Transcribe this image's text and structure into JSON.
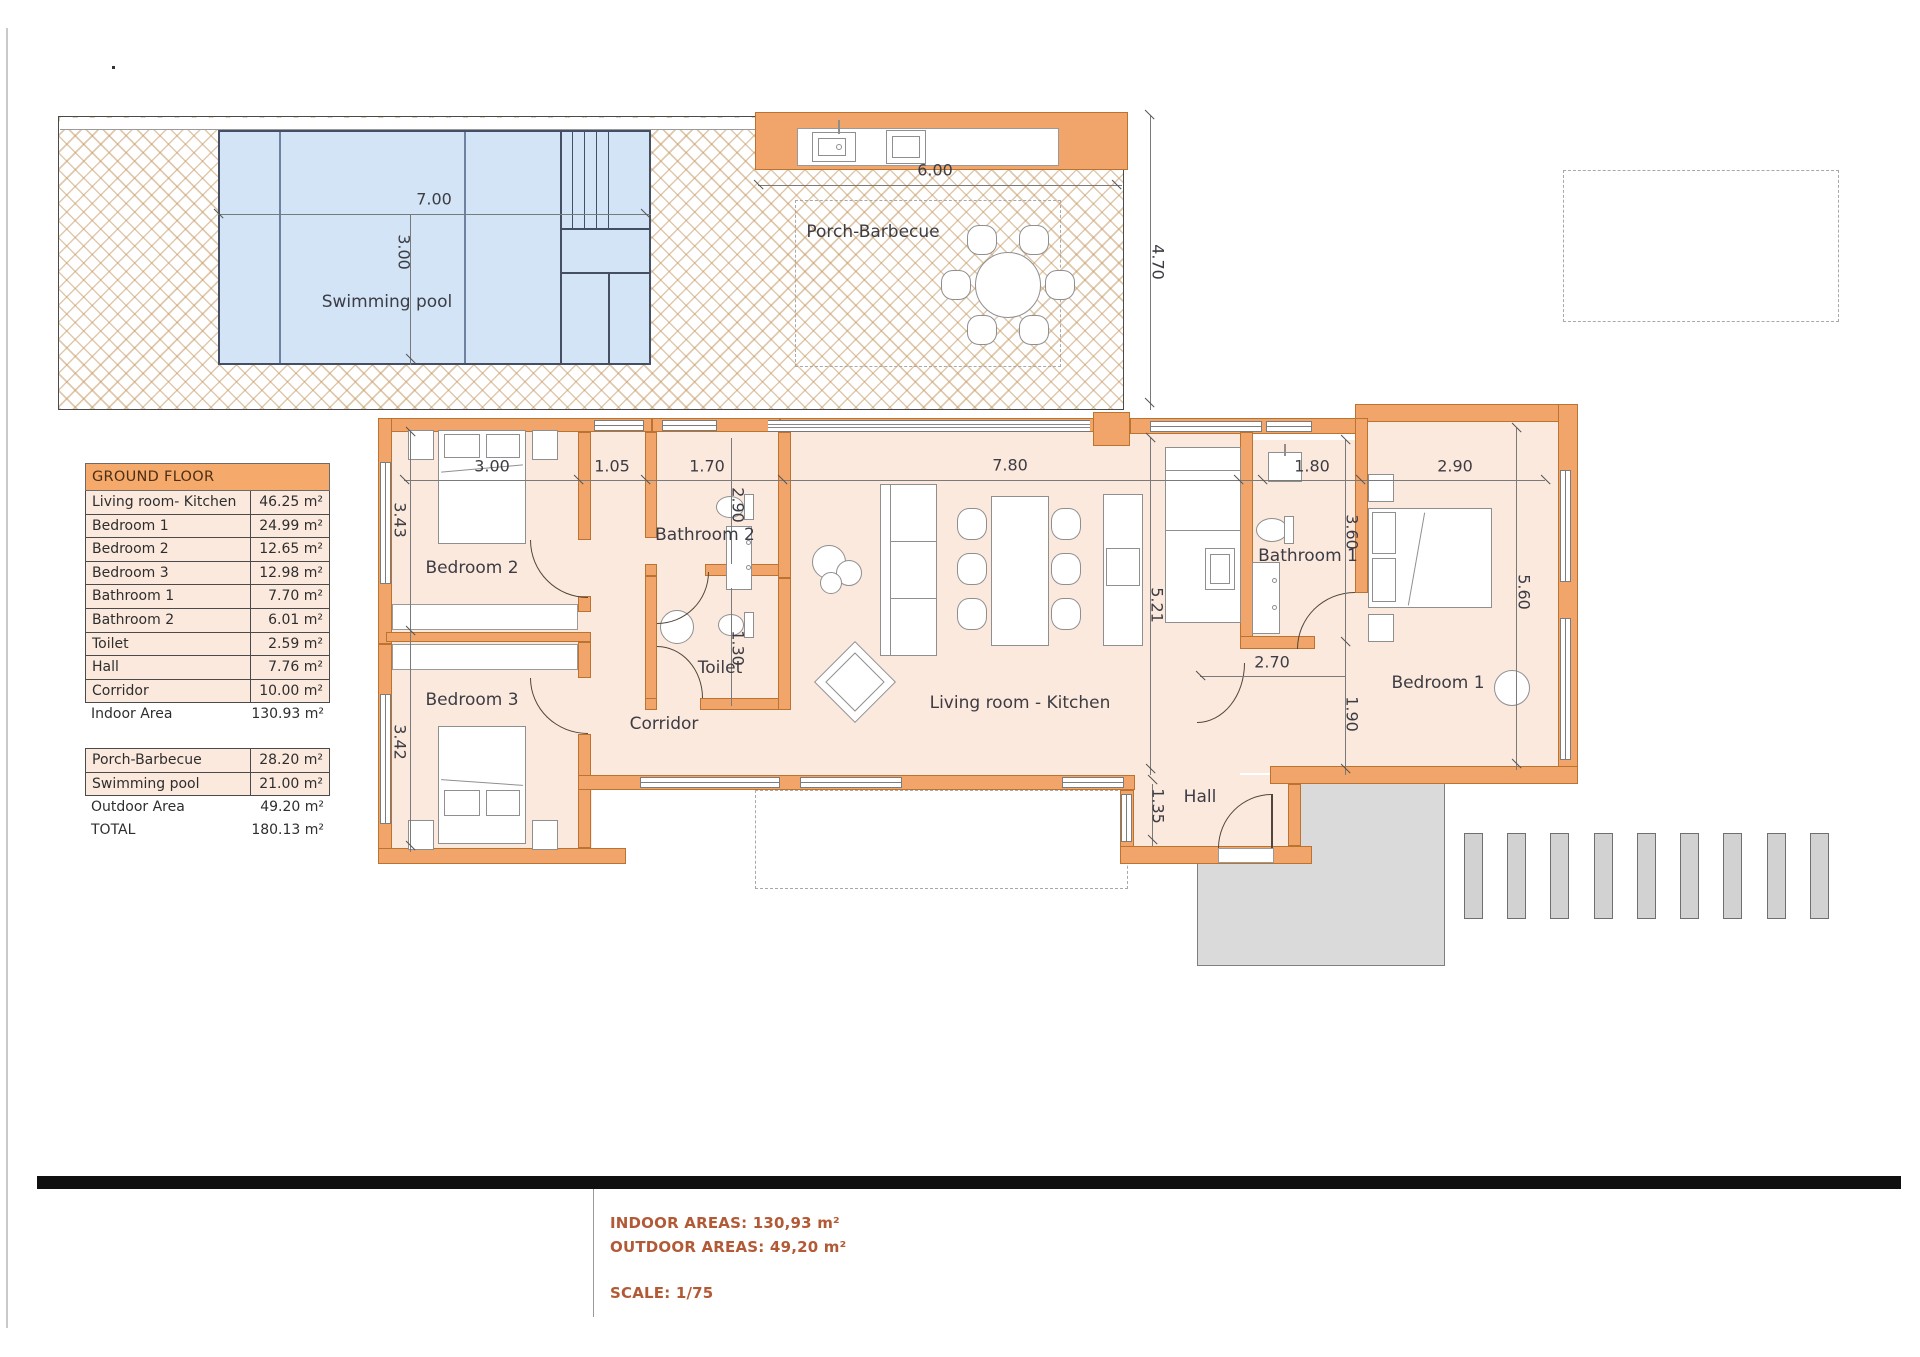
{
  "plan": {
    "room_labels": {
      "swimming_pool": "Swimming pool",
      "porch": "Porch-Barbecue",
      "bedroom1": "Bedroom 1",
      "bedroom2": "Bedroom 2",
      "bedroom3": "Bedroom 3",
      "bathroom1": "Bathroom 1",
      "bathroom2": "Bathroom 2",
      "toilet": "Toilet",
      "corridor": "Corridor",
      "living": "Living room - Kitchen",
      "hall": "Hall"
    },
    "dimensions": {
      "pool_w": "7.00",
      "pool_h": "3.00",
      "porch_w": "6.00",
      "porch_h": "4.70",
      "bed2_w": "3.00",
      "bed2_h": "3.43",
      "corr_top": "1.05",
      "bath2_w": "1.70",
      "bath2_h": "2.90",
      "toilet_h": "1.30",
      "bed3_h": "3.42",
      "living_w": "7.80",
      "living_h": "5.21",
      "bath1_w": "1.80",
      "bath1_h": "3.60",
      "bed1_w": "2.90",
      "bed1_h": "5.60",
      "entry_w": "2.70",
      "entry_h": "1.90",
      "hall_h": "1.35"
    }
  },
  "area_table": {
    "header": "GROUND FLOOR",
    "rows": [
      {
        "name": "Living room- Kitchen",
        "value": "46.25 m²"
      },
      {
        "name": "Bedroom 1",
        "value": "24.99 m²"
      },
      {
        "name": "Bedroom 2",
        "value": "12.65 m²"
      },
      {
        "name": "Bedroom 3",
        "value": "12.98 m²"
      },
      {
        "name": "Bathroom 1",
        "value": "7.70 m²"
      },
      {
        "name": "Bathroom 2",
        "value": "6.01 m²"
      },
      {
        "name": "Toilet",
        "value": "2.59 m²"
      },
      {
        "name": "Hall",
        "value": "7.76 m²"
      },
      {
        "name": "Corridor",
        "value": "10.00 m²"
      }
    ],
    "indoor_total": {
      "name": "Indoor Area",
      "value": "130.93 m²"
    },
    "outdoor_rows": [
      {
        "name": "Porch-Barbecue",
        "value": "28.20 m²"
      },
      {
        "name": "Swimming pool",
        "value": "21.00 m²"
      }
    ],
    "outdoor_total": {
      "name": "Outdoor Area",
      "value": "49.20 m²"
    },
    "grand_total": {
      "name": "TOTAL",
      "value": "180.13 m²"
    }
  },
  "footer": {
    "indoor": "INDOOR AREAS: 130,93 m²",
    "outdoor": "OUTDOOR AREAS: 49,20 m²",
    "scale": "SCALE: 1/75"
  },
  "colors": {
    "wall": "#f2a56b",
    "room_fill": "#fce9dd",
    "pool_fill": "#d2e4f6",
    "table_header": "#f5a96b",
    "footer_text": "#b25a36"
  }
}
